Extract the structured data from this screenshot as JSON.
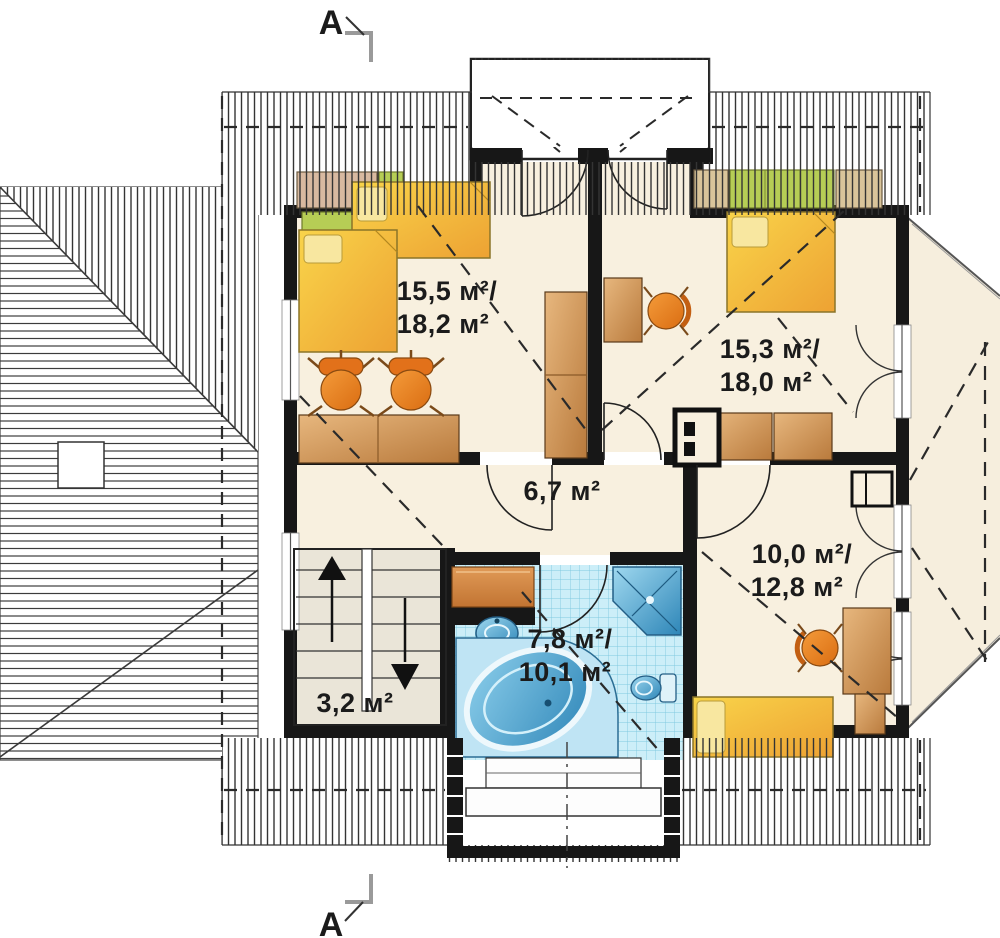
{
  "drawing": {
    "type": "floor-plan",
    "storey": "attic"
  },
  "section_marker": {
    "top": "A",
    "bottom": "A"
  },
  "rooms": {
    "bedroom_left": {
      "line1": "15,5 м²/",
      "line2": "18,2 м²"
    },
    "bedroom_right": {
      "line1": "15,3 м²/",
      "line2": "18,0 м²"
    },
    "hall": {
      "line1": "6,7 м²"
    },
    "bedroom_bottom": {
      "line1": "10,0 м²/",
      "line2": "12,8 м²"
    },
    "bathroom": {
      "line1": "7,8 м²/",
      "line2": "10,1 м²"
    },
    "stairs": {
      "line1": "3,2 м²"
    }
  },
  "colors": {
    "wall": "#171717",
    "floor": "#f8f0df",
    "bed_yellow": "#f0b83d",
    "wood": "#c98c4b",
    "chair_orange": "#ea7f1f",
    "furniture_green": "#b6cd55",
    "bath_tile": "#cceef8",
    "fixture_blue": "#5aa7d0"
  }
}
